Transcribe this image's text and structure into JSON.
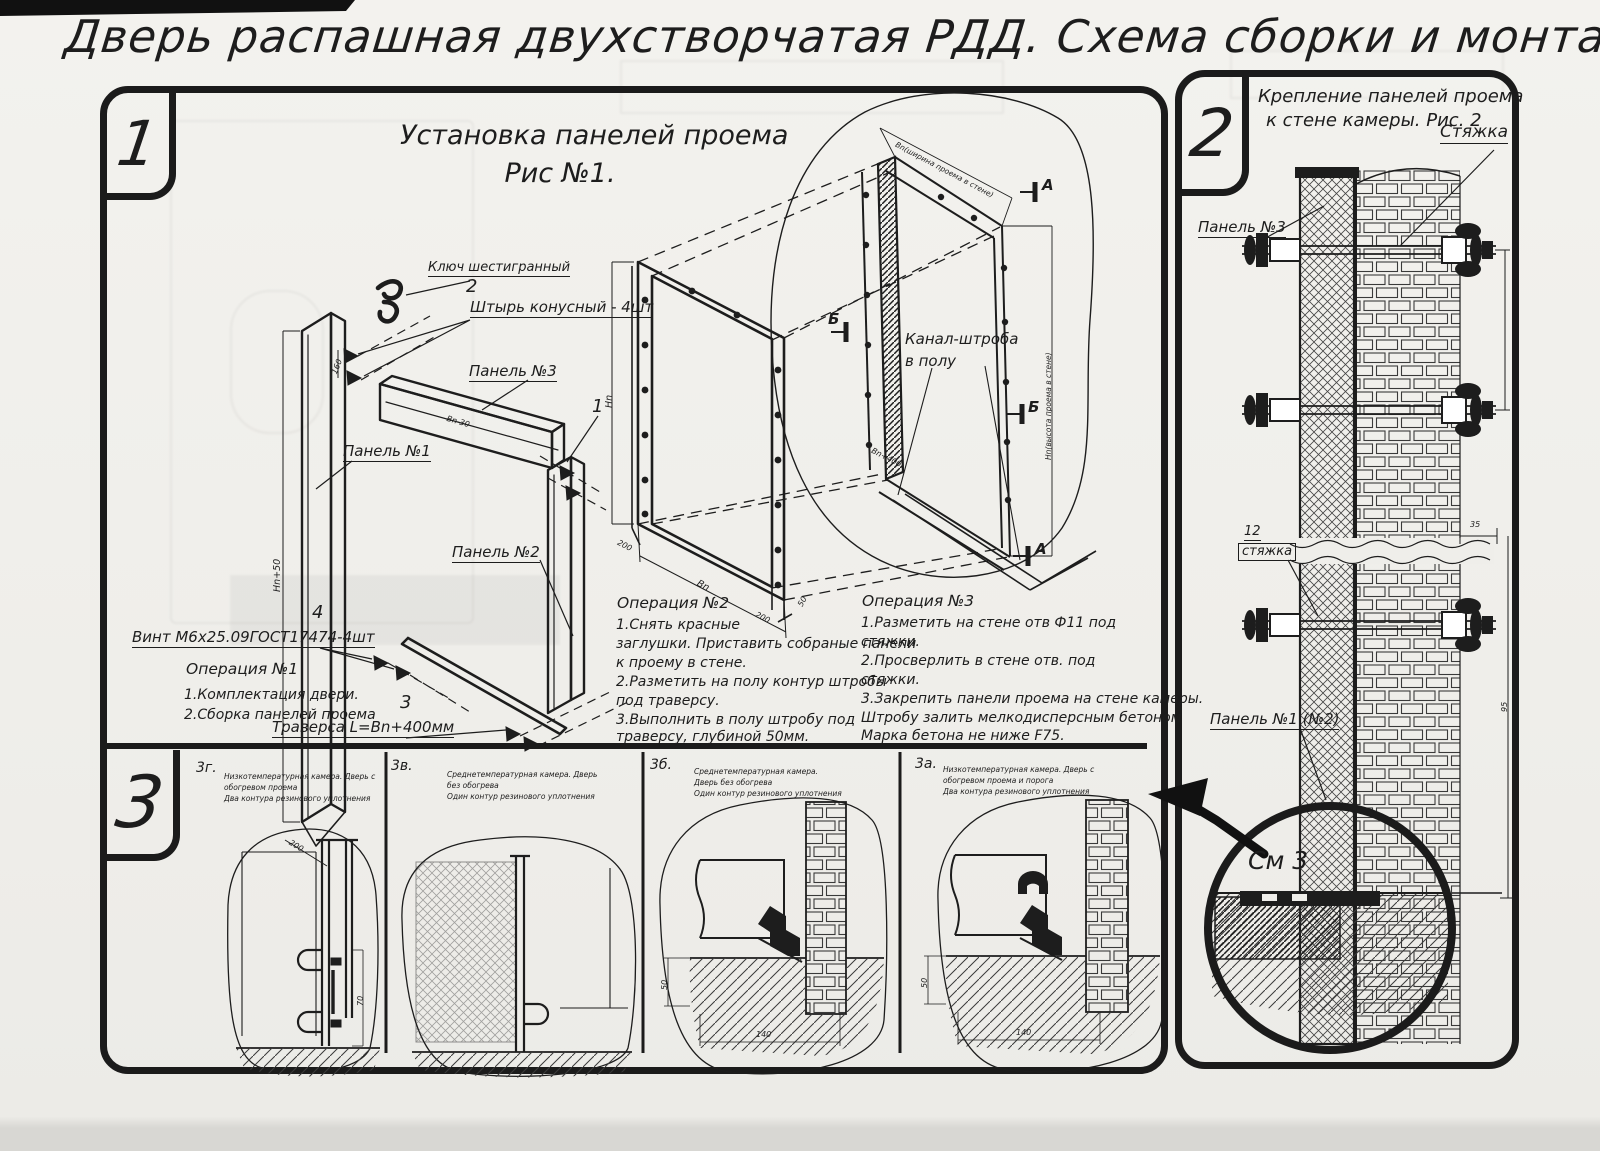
{
  "page": {
    "title": "Дверь распашная двухстворчатая РДД.  Схема сборки и монтажа №2"
  },
  "colors": {
    "paper": "#efeeea",
    "ink": "#1d1d1d"
  },
  "section1": {
    "badge": "1",
    "fig_title1": "Установка панелей проема",
    "fig_title2": "Рис №1.",
    "hex_key": "Ключ шестигранный",
    "pin_num": "2",
    "pin_label": "Штырь конусный - 4шт",
    "panel3_label": "Панель №3",
    "item1_num": "1",
    "panel1_label": "Панель №1",
    "panel2_label": "Панель №2",
    "screw_num": "4",
    "screw_label": "Винт М6х25.09ГОСТ17474-4шт",
    "traverse_num": "3",
    "traverse_label": "Траверса  L=Bn+400мм",
    "channel_label1": "Канал-штроба",
    "channel_label2": "в полу",
    "marker_a": "А",
    "marker_b": "Б",
    "dims": {
      "panel1_h": "Hn+50",
      "panel1_w": "200",
      "panel3_l": "Bn-30",
      "pin_gap": "160",
      "frame_h": "Hn",
      "frame_w": "Bn",
      "frame_foot1": "200",
      "frame_foot2": "200",
      "frame_d": "50",
      "traverse_l": "Bn+400",
      "opening_w": "Вn(ширина проема в стене)",
      "opening_h": "Hn(высота проема в стене)"
    },
    "op1": {
      "title": "Операция №1",
      "l1": "1.Комплектация двери.",
      "l2": "2.Сборка панелей проема"
    },
    "op2": {
      "title": "Операция №2",
      "l1": "1.Снять красные",
      "l2": "заглушки. Приставить собраные панели",
      "l3": "к проему в стене.",
      "l4": "2.Разметить на полу контур штробы",
      "l5": "под траверсу.",
      "l6": "3.Выполнить в полу штробу под",
      "l7": "траверсу, глубиной 50мм."
    },
    "op3": {
      "title": "Операция №3",
      "l1": "1.Разметить на стене отв Ф11 под",
      "l2": "стяжки.",
      "l3": "2.Просверлить в стене отв.  под",
      "l4": "стяжки.",
      "l5": "3.Закрепить панели проема на стене камеры.",
      "l6": "Штробу залить мелкодисперсным бетоном",
      "l7": "Марка бетона не ниже  F75."
    }
  },
  "section2": {
    "badge": "2",
    "title1": "Крепление панелей проема",
    "title2": "к стене камеры. Рис. 2",
    "tie_label": "Стяжка",
    "panel3_label": "Панель №3",
    "tie_num": "12",
    "tie_small": "стяжка",
    "panel12_label": "Панель №1 (№2)",
    "see_detail": "См 3",
    "dim35": "35",
    "dim95": "95"
  },
  "section3": {
    "badge": "3",
    "panels": [
      {
        "code": "3г.",
        "cap1": "Низкотемпературная камера. Дверь с обогревом проема",
        "cap2": "Два контура резинового уплотнения",
        "dim_seal": "70"
      },
      {
        "code": "3в.",
        "cap1": "Среднетемпературная камера. Дверь без обогрева",
        "cap2": "Один контур резинового уплотнения"
      },
      {
        "code": "3б.",
        "cap1": "Среднетемпературная камера. Дверь без обогрева",
        "cap2": "Один контур резинового уплотнения",
        "dim_h": "50",
        "dim_w": "140"
      },
      {
        "code": "3а.",
        "cap1": "Низкотемпературная камера. Дверь с обогревом проема и порога",
        "cap2": "Два контура резинового уплотнения",
        "dim_h": "50",
        "dim_w": "140"
      }
    ]
  }
}
